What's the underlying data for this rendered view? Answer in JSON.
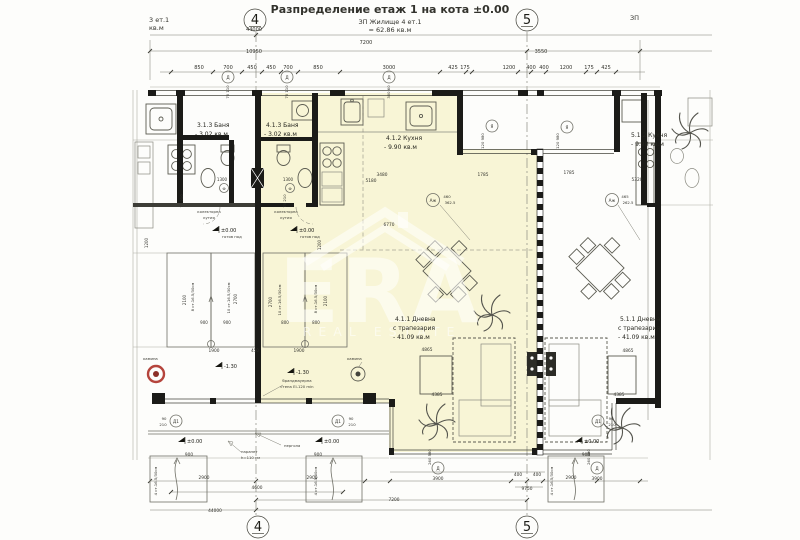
{
  "header": {
    "title": "Разпределение етаж 1 на кота ±0.00",
    "zp_line1": "ЗП Жилище 4 ет.1",
    "zp_line2": "= 62.86 кв.м",
    "left_neighbor_line1": "3 ет.1",
    "left_neighbor_line2": "кв.м",
    "right_neighbor": "ЗП"
  },
  "grid_axes": {
    "axis_4": "4",
    "axis_5": "5"
  },
  "rooms": {
    "apt3_bath_name": "3.1.3 Баня",
    "apt3_bath_area": "- 3.02 кв.м",
    "apt4_bath_name": "4.1.3 Баня",
    "apt4_bath_area": "- 3.02 кв.м",
    "apt4_kitchen_name": "4.1.2 Кухня",
    "apt4_kitchen_area": "- 9.90 кв.м",
    "apt4_living_name": "4.1.1 Дневна",
    "apt4_living_sub": "с трапезария",
    "apt4_living_area": "- 41.09 кв.м",
    "apt5_kitchen_name": "5.1.2 Кухня",
    "apt5_kitchen_area": "- 9.90 кв.м",
    "apt5_living_name": "5.1.1 Дневна",
    "apt5_living_sub": "с трапезария",
    "apt5_living_area": "- 41.09 кв.м"
  },
  "annotations": {
    "level_zero": "±0.00",
    "finished_floor": "готов под",
    "level_minus": "-1.30",
    "fireplace": "камина",
    "collector_line1": "колекторна",
    "collector_line2": "кутия",
    "parapet_line1": "парапет",
    "parapet_line2": "h=110 см",
    "pergola": "пергола",
    "firewall_line1": "брандмауерна",
    "firewall_line2": "стена EI-120 min"
  },
  "marks": {
    "window_d": "Д",
    "door_d1": "Д1",
    "mark_azh": "Аж",
    "mark_ya": "Я",
    "mark_f": "Ф"
  },
  "watermark": {
    "logo_text": "ERA",
    "tagline": "REAL ESTATE"
  },
  "dim_labels": [
    {
      "t": "44000",
      "x": 254,
      "y": 31
    },
    {
      "t": "7200",
      "x": 366,
      "y": 44
    },
    {
      "t": "10950",
      "x": 254,
      "y": 53
    },
    {
      "t": "3550",
      "x": 541,
      "y": 53
    },
    {
      "t": "850",
      "x": 199,
      "y": 69
    },
    {
      "t": "700",
      "x": 228,
      "y": 69
    },
    {
      "t": "450",
      "x": 252,
      "y": 69
    },
    {
      "t": "450",
      "x": 271,
      "y": 69
    },
    {
      "t": "700",
      "x": 288,
      "y": 69
    },
    {
      "t": "850",
      "x": 318,
      "y": 69
    },
    {
      "t": "3000",
      "x": 389,
      "y": 69
    },
    {
      "t": "425",
      "x": 453,
      "y": 69
    },
    {
      "t": "175",
      "x": 465,
      "y": 69
    },
    {
      "t": "1200",
      "x": 509,
      "y": 69
    },
    {
      "t": "400",
      "x": 531,
      "y": 69
    },
    {
      "t": "400",
      "x": 544,
      "y": 69
    },
    {
      "t": "1200",
      "x": 566,
      "y": 69
    },
    {
      "t": "175",
      "x": 589,
      "y": 69
    },
    {
      "t": "425",
      "x": 606,
      "y": 69
    },
    {
      "t": "70 110",
      "x": 229,
      "y": 92,
      "r": -90,
      "s": 3.8
    },
    {
      "t": "70 110",
      "x": 288,
      "y": 92,
      "r": -90,
      "s": 3.8
    },
    {
      "t": "300 60",
      "x": 390,
      "y": 92,
      "r": -90,
      "s": 3.8
    },
    {
      "t": "120 980",
      "x": 484,
      "y": 141,
      "r": -90,
      "s": 3.8
    },
    {
      "t": "120 980",
      "x": 559,
      "y": 141,
      "r": -90,
      "s": 3.8
    },
    {
      "t": "3480",
      "x": 382,
      "y": 176,
      "s": 4.3
    },
    {
      "t": "5180",
      "x": 371,
      "y": 182,
      "s": 4.3
    },
    {
      "t": "1785",
      "x": 483,
      "y": 176,
      "s": 4.3
    },
    {
      "t": "1785",
      "x": 569,
      "y": 174,
      "s": 4.3
    },
    {
      "t": "5320",
      "x": 637,
      "y": 181,
      "s": 4.3
    },
    {
      "t": "6770",
      "x": 389,
      "y": 226,
      "s": 4.3
    },
    {
      "t": "1300",
      "x": 222,
      "y": 181,
      "s": 4
    },
    {
      "t": "1300",
      "x": 288,
      "y": 181,
      "s": 4
    },
    {
      "t": "70 210",
      "x": 183,
      "y": 201,
      "r": -90,
      "s": 3.8
    },
    {
      "t": "70 210",
      "x": 286,
      "y": 201,
      "r": -90,
      "s": 3.8
    },
    {
      "t": "460",
      "x": 447,
      "y": 198,
      "s": 3.8
    },
    {
      "t": "362.5",
      "x": 450,
      "y": 204,
      "s": 3.8
    },
    {
      "t": "465",
      "x": 625,
      "y": 198,
      "s": 3.8
    },
    {
      "t": "262.5",
      "x": 628,
      "y": 204,
      "s": 3.8
    },
    {
      "t": "1200",
      "x": 148,
      "y": 243,
      "r": -90,
      "s": 4
    },
    {
      "t": "1200",
      "x": 321,
      "y": 245,
      "r": -90,
      "s": 4
    },
    {
      "t": "2100",
      "x": 186,
      "y": 300,
      "r": -90,
      "s": 4
    },
    {
      "t": "2700",
      "x": 237,
      "y": 299,
      "r": -90,
      "s": 4
    },
    {
      "t": "2700",
      "x": 272,
      "y": 302,
      "r": -90,
      "s": 4
    },
    {
      "t": "2100",
      "x": 327,
      "y": 301,
      "r": -90,
      "s": 4
    },
    {
      "t": "8 ст.16.5/30см",
      "x": 194,
      "y": 297,
      "r": -90,
      "s": 3.8
    },
    {
      "t": "10 ст.16.5/30см",
      "x": 230,
      "y": 298,
      "r": -90,
      "s": 3.8
    },
    {
      "t": "10 ст.16.5/30см",
      "x": 281,
      "y": 300,
      "r": -90,
      "s": 3.8
    },
    {
      "t": "8 ст.16.5/30см",
      "x": 317,
      "y": 299,
      "r": -90,
      "s": 3.8
    },
    {
      "t": "900",
      "x": 204,
      "y": 324,
      "s": 4
    },
    {
      "t": "900",
      "x": 227,
      "y": 324,
      "s": 4
    },
    {
      "t": "800",
      "x": 285,
      "y": 324,
      "s": 4
    },
    {
      "t": "800",
      "x": 316,
      "y": 324,
      "s": 4
    },
    {
      "t": "1900",
      "x": 214,
      "y": 352,
      "s": 4.3
    },
    {
      "t": "450",
      "x": 255,
      "y": 352,
      "s": 4
    },
    {
      "t": "1900",
      "x": 299,
      "y": 352,
      "s": 4.3
    },
    {
      "t": "4865",
      "x": 427,
      "y": 351,
      "s": 4.3
    },
    {
      "t": "4865",
      "x": 628,
      "y": 352,
      "s": 4.3
    },
    {
      "t": "4385",
      "x": 437,
      "y": 396,
      "s": 4.3
    },
    {
      "t": "4385",
      "x": 619,
      "y": 396,
      "s": 4.3
    },
    {
      "t": "90",
      "x": 164,
      "y": 420,
      "s": 3.8
    },
    {
      "t": "210",
      "x": 163,
      "y": 426,
      "s": 3.8
    },
    {
      "t": "90",
      "x": 351,
      "y": 420,
      "s": 3.8
    },
    {
      "t": "210",
      "x": 352,
      "y": 426,
      "s": 3.8
    },
    {
      "t": "90",
      "x": 611,
      "y": 420,
      "s": 3.8
    },
    {
      "t": "210",
      "x": 612,
      "y": 426,
      "s": 3.8
    },
    {
      "t": "900",
      "x": 189,
      "y": 456,
      "s": 4.3
    },
    {
      "t": "900",
      "x": 318,
      "y": 456,
      "s": 4.3
    },
    {
      "t": "900",
      "x": 586,
      "y": 456,
      "s": 4.3
    },
    {
      "t": "2900",
      "x": 204,
      "y": 479,
      "s": 4.3
    },
    {
      "t": "2900",
      "x": 312,
      "y": 479,
      "s": 4.3
    },
    {
      "t": "2900",
      "x": 571,
      "y": 479,
      "s": 4.3
    },
    {
      "t": "260 580",
      "x": 431,
      "y": 457,
      "r": -90,
      "s": 3.8
    },
    {
      "t": "260 580",
      "x": 590,
      "y": 457,
      "r": -90,
      "s": 3.8
    },
    {
      "t": "3900",
      "x": 438,
      "y": 480,
      "s": 4.3
    },
    {
      "t": "3900",
      "x": 597,
      "y": 480,
      "s": 4.3
    },
    {
      "t": "400",
      "x": 518,
      "y": 476,
      "s": 4.3
    },
    {
      "t": "400",
      "x": 537,
      "y": 476,
      "s": 4.3
    },
    {
      "t": "9750",
      "x": 527,
      "y": 490,
      "s": 4.3
    },
    {
      "t": "4600",
      "x": 257,
      "y": 489,
      "s": 4.3
    },
    {
      "t": "7200",
      "x": 394,
      "y": 501,
      "s": 4.3
    },
    {
      "t": "44000",
      "x": 215,
      "y": 512,
      "s": 4.3
    },
    {
      "t": "4 ст.16.5/30см",
      "x": 157,
      "y": 481,
      "r": -90,
      "s": 3.8
    },
    {
      "t": "4 ст.16.5/30см",
      "x": 317,
      "y": 481,
      "r": -90,
      "s": 3.8
    },
    {
      "t": "4 ст.16.5/30см",
      "x": 553,
      "y": 481,
      "r": -90,
      "s": 3.8
    }
  ]
}
